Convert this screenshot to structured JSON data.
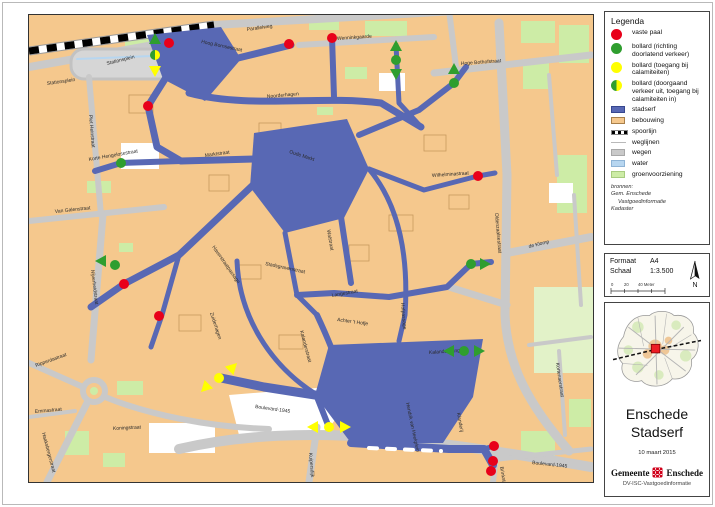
{
  "legend": {
    "title": "Legenda",
    "items": [
      {
        "swatch": "dot",
        "color": "#e8001a",
        "label": "vaste paal"
      },
      {
        "swatch": "dot",
        "color": "#2f9e2f",
        "label": "bollard (richting doorlatend verkeer)"
      },
      {
        "swatch": "dot",
        "color": "#ffff00",
        "label": "bollard (toegang bij calamiteiten)"
      },
      {
        "swatch": "half-dot",
        "color": "#2f9e2f",
        "color2": "#ffff00",
        "label": "bollard (doorgaand verkeer uit, toegang bij calamiteiten in)"
      },
      {
        "swatch": "rect",
        "color": "#5868b4",
        "border": "#37478f",
        "label": "stadserf"
      },
      {
        "swatch": "rect",
        "color": "#f5c88d",
        "border": "#a87f4a",
        "label": "bebouwing"
      },
      {
        "swatch": "rail",
        "color": "#000000",
        "label": "spoorlijn"
      },
      {
        "swatch": "line",
        "color": "#b9b9b9",
        "label": "weglijnen"
      },
      {
        "swatch": "rect",
        "color": "#c9c9c9",
        "border": "#a8a8a8",
        "label": "wegen"
      },
      {
        "swatch": "rect",
        "color": "#b7d6f0",
        "border": "#8fb4d6",
        "label": "water"
      },
      {
        "swatch": "rect",
        "color": "#cdeca6",
        "border": "#a8cc80",
        "label": "groenvoorziening"
      }
    ]
  },
  "sources": {
    "heading": "bronnen:",
    "lines": [
      "Gem. Enschede",
      "Vastgoedinformatie",
      "Kadaster"
    ]
  },
  "format_box": {
    "format_label": "Formaat",
    "format_value": "A4",
    "scale_label": "Schaal",
    "scale_value": "1:3.500",
    "scalebar_labels": [
      "0",
      "20",
      "40 Meter"
    ],
    "north_label": "N"
  },
  "title_box": {
    "title_line1": "Enschede",
    "title_line2": "Stadserf",
    "date": "10 maart 2015",
    "org_left": "Gemeente",
    "org_right": "Enschede",
    "dept": "DV-ISC-Vastgoedinformatie"
  },
  "colors": {
    "stadserf": "#5868b4",
    "bebouwing": "#f5c88d",
    "wegen": "#c9c9c9",
    "water": "#b7d6f0",
    "groen": "#cdeca6",
    "vaste_paal": "#e8001a",
    "bollard_groen": "#2f9e2f",
    "bollard_geel": "#ffff00"
  },
  "map": {
    "street_labels": [
      {
        "t": "Parallelweg",
        "x": 218,
        "y": 16,
        "r": -8
      },
      {
        "t": "Stationsplein",
        "x": 78,
        "y": 50,
        "r": -14
      },
      {
        "t": "Stationsplein",
        "x": 18,
        "y": 70,
        "r": -8
      },
      {
        "t": "Piet Heinstraat",
        "x": 60,
        "y": 100,
        "r": 85
      },
      {
        "t": "Hoog Bornsestraat",
        "x": 172,
        "y": 28,
        "r": 12
      },
      {
        "t": "Wenninkgaarde",
        "x": 308,
        "y": 25,
        "r": -4
      },
      {
        "t": "Hoge Bothofstraat",
        "x": 432,
        "y": 50,
        "r": -4
      },
      {
        "t": "Noorderhagen",
        "x": 238,
        "y": 83,
        "r": -5
      },
      {
        "t": "Korte Hengelosestraat",
        "x": 60,
        "y": 146,
        "r": -10
      },
      {
        "t": "Marktstraat",
        "x": 176,
        "y": 142,
        "r": -8
      },
      {
        "t": "Oude Markt",
        "x": 260,
        "y": 138,
        "r": 18
      },
      {
        "t": "Van Galenstraat",
        "x": 26,
        "y": 198,
        "r": -6
      },
      {
        "t": "Nijverheidstraat",
        "x": 62,
        "y": 255,
        "r": 83
      },
      {
        "t": "Stadsgravenstraat",
        "x": 236,
        "y": 250,
        "r": 12
      },
      {
        "t": "Haverstraatpassage",
        "x": 183,
        "y": 232,
        "r": 55
      },
      {
        "t": "Walstraat",
        "x": 298,
        "y": 215,
        "r": 80
      },
      {
        "t": "Langestraat",
        "x": 303,
        "y": 282,
        "r": -10
      },
      {
        "t": "Hofpassage",
        "x": 372,
        "y": 288,
        "r": 85
      },
      {
        "t": "Achter 't Hofje",
        "x": 308,
        "y": 306,
        "r": 8
      },
      {
        "t": "Kalanderstraat",
        "x": 271,
        "y": 316,
        "r": 75
      },
      {
        "t": "Zuiderhagen",
        "x": 181,
        "y": 298,
        "r": 72
      },
      {
        "t": "Wilhelminastraat",
        "x": 403,
        "y": 162,
        "r": -4
      },
      {
        "t": "Oldenzaalsestraat",
        "x": 466,
        "y": 198,
        "r": 85
      },
      {
        "t": "de Klomp",
        "x": 500,
        "y": 233,
        "r": -14
      },
      {
        "t": "Kalandergang",
        "x": 400,
        "y": 339,
        "r": -4
      },
      {
        "t": "Hendrik van Heekplein",
        "x": 377,
        "y": 388,
        "r": 78
      },
      {
        "t": "Klanderij",
        "x": 428,
        "y": 398,
        "r": 80
      },
      {
        "t": "Kuipersdijk",
        "x": 280,
        "y": 438,
        "r": 85
      },
      {
        "t": "Brinkstraat",
        "x": 471,
        "y": 452,
        "r": 80
      },
      {
        "t": "Boulevard-1945",
        "x": 226,
        "y": 393,
        "r": 8
      },
      {
        "t": "Boulevard-1945",
        "x": 503,
        "y": 449,
        "r": 6
      },
      {
        "t": "Koningstraat",
        "x": 84,
        "y": 415,
        "r": -3
      },
      {
        "t": "Emmastraat",
        "x": 6,
        "y": 398,
        "r": -5
      },
      {
        "t": "Ripperdastraat",
        "x": 7,
        "y": 352,
        "r": -20
      },
      {
        "t": "Haaksbergerstraat",
        "x": 13,
        "y": 418,
        "r": 75
      },
      {
        "t": "Kortenaerstraat",
        "x": 527,
        "y": 348,
        "r": 82
      }
    ],
    "markers": {
      "red_dots": [
        [
          140,
          28
        ],
        [
          260,
          29
        ],
        [
          303,
          23
        ],
        [
          119,
          91
        ],
        [
          449,
          161
        ],
        [
          95,
          269
        ],
        [
          130,
          301
        ],
        [
          465,
          431
        ],
        [
          464,
          446
        ],
        [
          462,
          456
        ]
      ],
      "green_dots": [
        [
          92,
          148
        ],
        [
          86,
          250
        ],
        [
          425,
          68
        ],
        [
          367,
          45
        ],
        [
          442,
          249
        ],
        [
          435,
          336
        ]
      ],
      "yellow_dots": [
        [
          190,
          363
        ],
        [
          300,
          412
        ]
      ],
      "half_dots": [
        [
          126,
          40
        ]
      ],
      "green_arrows": [
        {
          "x": 126,
          "y": 25,
          "d": "up"
        },
        {
          "x": 73,
          "y": 246,
          "d": "left"
        },
        {
          "x": 425,
          "y": 55,
          "d": "up"
        },
        {
          "x": 367,
          "y": 32,
          "d": "up"
        },
        {
          "x": 367,
          "y": 58,
          "d": "down"
        },
        {
          "x": 455,
          "y": 249,
          "d": "right"
        },
        {
          "x": 421,
          "y": 336,
          "d": "left"
        },
        {
          "x": 449,
          "y": 336,
          "d": "right"
        }
      ],
      "yellow_arrows": [
        {
          "x": 126,
          "y": 55,
          "d": "down"
        },
        {
          "x": 203,
          "y": 353,
          "d": "ne"
        },
        {
          "x": 177,
          "y": 372,
          "d": "sw"
        },
        {
          "x": 285,
          "y": 412,
          "d": "left"
        },
        {
          "x": 315,
          "y": 412,
          "d": "right"
        }
      ]
    }
  }
}
